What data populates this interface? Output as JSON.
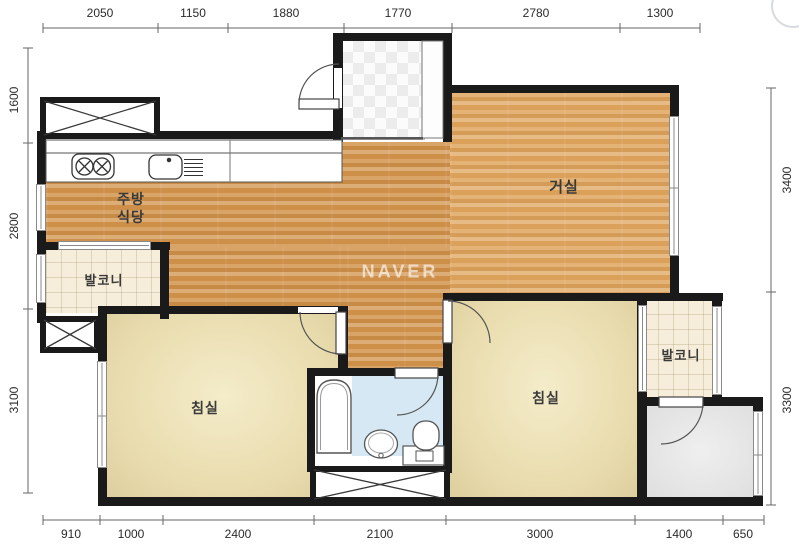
{
  "watermark": "NAVER",
  "colors": {
    "wall": "#1a1a1a",
    "wood-kitchen": "#d2924a",
    "wood-living": "#dfa45c",
    "bedroom": "#e9dcae",
    "balcony": "#f6eedb",
    "bath": "#d6e8f3",
    "utility": "#e6e6e6",
    "dim-text": "#2b2b2b",
    "label-text": "#3a3a3a"
  },
  "dimensions": {
    "top": [
      "2050",
      "1150",
      "1880",
      "1770",
      "2780",
      "1300"
    ],
    "bottom": [
      "910",
      "1000",
      "2400",
      "2100",
      "3000",
      "1400",
      "650"
    ],
    "left": [
      "1600",
      "2800",
      "3100"
    ],
    "right": [
      "3400",
      "3300"
    ]
  },
  "rooms": {
    "kitchen_dining": {
      "line1": "주방",
      "line2": "식당"
    },
    "living": "거실",
    "bedroom_left": "침실",
    "bedroom_right": "침실",
    "balcony_left": "발코니",
    "balcony_right": "발코니"
  }
}
